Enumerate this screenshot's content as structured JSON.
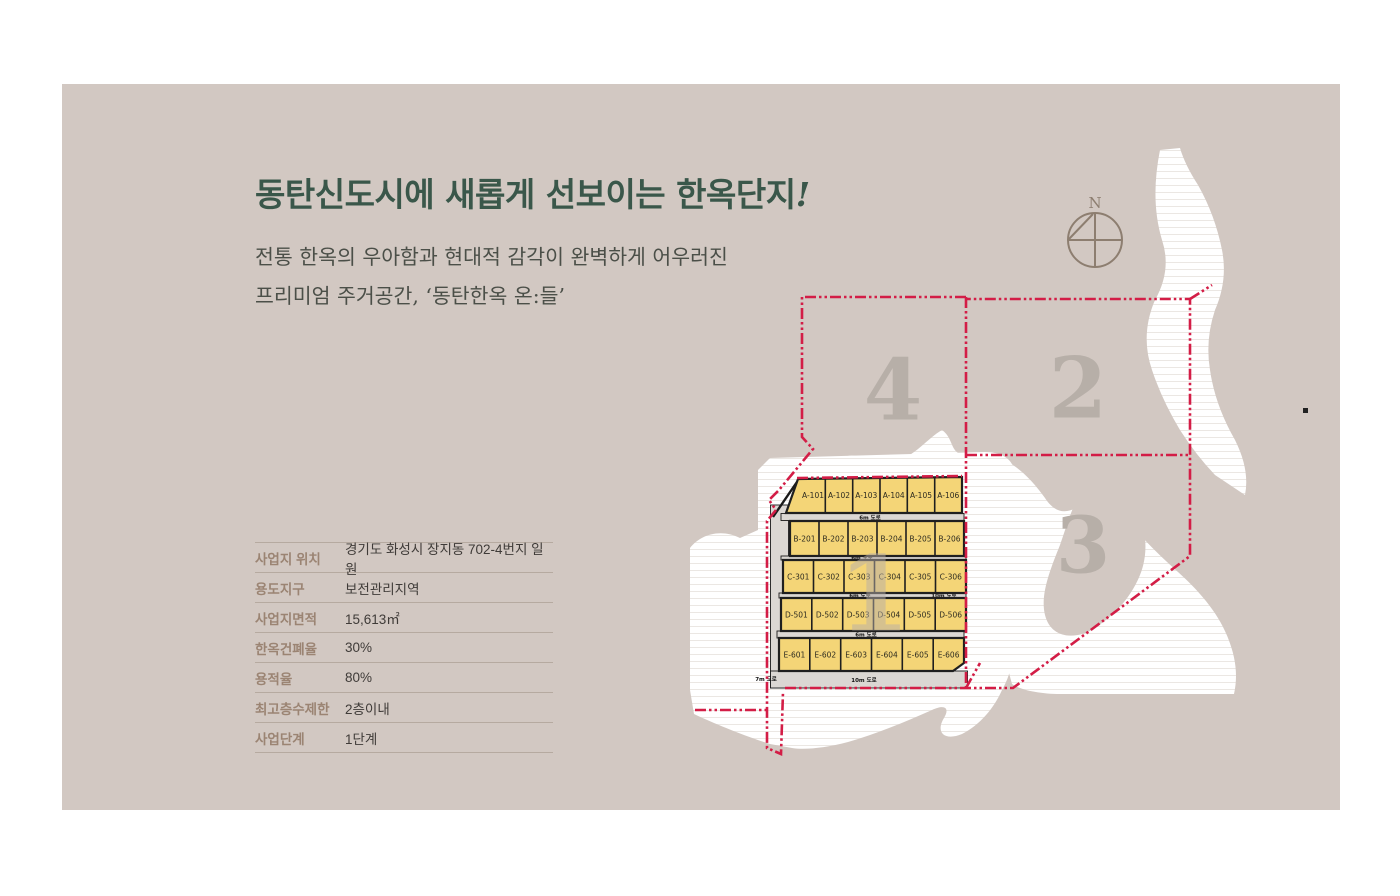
{
  "slide": {
    "title": "동탄신도시에 새롭게 선보이는 한옥단지",
    "title_bang": "!",
    "subtitle_line1": "전통 한옥의 우아함과 현대적 감각이 완벽하게 어우러진",
    "subtitle_line2": "프리미엄 주거공간, ‘동탄한옥 온:들’"
  },
  "info_table": {
    "rows": [
      {
        "label": "사업지 위치",
        "value": "경기도 화성시 장지동 702-4번지 일원"
      },
      {
        "label": "용도지구",
        "value": "보전관리지역"
      },
      {
        "label": "사업지면적",
        "value": "15,613㎡"
      },
      {
        "label": "한옥건폐율",
        "value": "30%"
      },
      {
        "label": "용적율",
        "value": "80%"
      },
      {
        "label": "최고층수제한",
        "value": "2층이내"
      },
      {
        "label": "사업단계",
        "value": "1단계"
      }
    ]
  },
  "map": {
    "compass_label": "N",
    "zone_labels": {
      "z1": "1",
      "z2": "2",
      "z3": "3",
      "z4": "4"
    },
    "blocks": [
      {
        "row": "A",
        "lots": [
          "A-101",
          "A-102",
          "A-103",
          "A-104",
          "A-105",
          "A-106"
        ]
      },
      {
        "row": "B",
        "lots": [
          "B-201",
          "B-202",
          "B-203",
          "B-204",
          "B-205",
          "B-206"
        ]
      },
      {
        "row": "C",
        "lots": [
          "C-301",
          "C-302",
          "C-303",
          "C-304",
          "C-305",
          "C-306"
        ]
      },
      {
        "row": "D",
        "lots": [
          "D-501",
          "D-502",
          "D-503",
          "D-504",
          "D-505",
          "D-506"
        ]
      },
      {
        "row": "E",
        "lots": [
          "E-601",
          "E-602",
          "E-603",
          "E-604",
          "E-605",
          "E-606"
        ]
      }
    ],
    "road_labels": {
      "gap_road": "6m 도로",
      "side_road": "10m 도로",
      "bottom_road": "10m 도로",
      "left_road": "7m 도로"
    },
    "colors": {
      "card_bg": "#d2c8c2",
      "accent_red": "#d31d46",
      "lot_yellow": "#f4d577",
      "title_green": "#3a574a",
      "label_brown": "#9b8473",
      "compass_gray": "#8d7e70",
      "zone_gray": "#b7afa8"
    }
  }
}
